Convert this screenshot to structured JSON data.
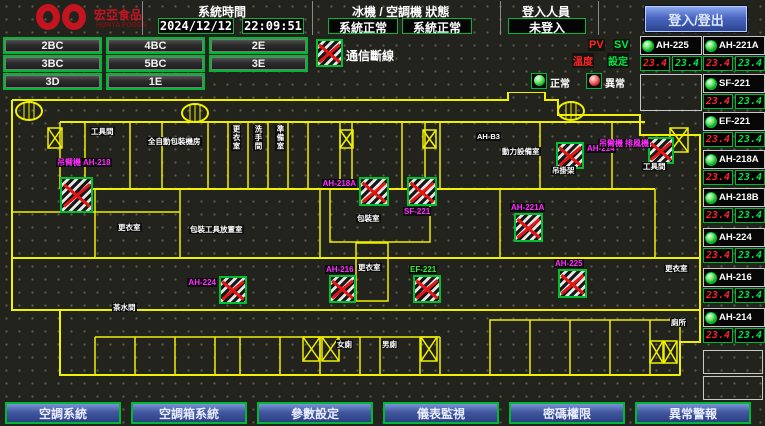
{
  "header": {
    "logo": {
      "name": "宏亞食品",
      "subname": "HUNYA FOODS"
    },
    "time_section": {
      "label": "系統時間",
      "date": "2024/12/12",
      "time": "22:09:51"
    },
    "status_section": {
      "label": "冰機 / 空調機 狀態",
      "chiller": "系統正常",
      "ahu": "系統正常"
    },
    "login_section": {
      "label": "登入人員",
      "user": "未登入",
      "button": "登入/登出"
    }
  },
  "floor_nav": {
    "rows": [
      [
        "2BC",
        "4BC",
        "2E"
      ],
      [
        "3BC",
        "5BC",
        "3E"
      ],
      [
        "3D",
        "1E"
      ]
    ]
  },
  "legend": {
    "comm_loss": "通信斷線",
    "normal": "正常",
    "abnormal": "異常",
    "pv": "PV",
    "sv": "SV",
    "pv_name": "溫度",
    "sv_name": "設定"
  },
  "equipment": [
    {
      "id": "AH-225",
      "pv": "23.4",
      "sv": "23.4",
      "status": "normal"
    },
    {
      "id": "AH-221A",
      "pv": "23.4",
      "sv": "23.4",
      "status": "normal"
    },
    {
      "id": "SF-221",
      "pv": "23.4",
      "sv": "23.4",
      "status": "normal"
    },
    {
      "id": "EF-221",
      "pv": "23.4",
      "sv": "23.4",
      "status": "normal"
    },
    {
      "id": "AH-218A",
      "pv": "23.4",
      "sv": "23.4",
      "status": "normal"
    },
    {
      "id": "AH-218B",
      "pv": "23.4",
      "sv": "23.4",
      "status": "normal"
    },
    {
      "id": "AH-224",
      "pv": "23.4",
      "sv": "23.4",
      "status": "normal"
    },
    {
      "id": "AH-216",
      "pv": "23.4",
      "sv": "23.4",
      "status": "normal"
    },
    {
      "id": "AH-214",
      "pv": "23.4",
      "sv": "23.4",
      "status": "normal"
    }
  ],
  "nav_buttons": [
    "空調系統",
    "空調箱系統",
    "參數設定",
    "儀表監視",
    "密碼權限",
    "異常警報"
  ],
  "colors": {
    "accent_green": "#00b833",
    "alarm_red": "#e31515",
    "equip_magenta": "#ff2bff",
    "wall_yellow": "#f0f000",
    "nav_blue": "#41579f",
    "logo_red": "#c41420"
  },
  "map": {
    "markers": [
      {
        "id": "AH-218",
        "x": 60,
        "y": 177,
        "w": 33,
        "h": 36,
        "label": [
          "吊臂機",
          "AH-218"
        ],
        "color": "#ff2bff",
        "pos": "above"
      },
      {
        "id": "AH-218A",
        "x": 359,
        "y": 177,
        "w": 30,
        "h": 29,
        "label": [
          "AH-218A"
        ],
        "color": "#ff2bff",
        "pos": "left"
      },
      {
        "id": "SF-221",
        "x": 407,
        "y": 177,
        "w": 30,
        "h": 29,
        "label": [
          "SF-221"
        ],
        "color": "#ff2bff",
        "pos": "below"
      },
      {
        "id": "AH-214",
        "x": 556,
        "y": 142,
        "w": 28,
        "h": 27,
        "label": [
          "AH-214"
        ],
        "color": "#ff2bff",
        "pos": "right"
      },
      {
        "id": "crane",
        "x": 648,
        "y": 137,
        "w": 26,
        "h": 27,
        "label": [
          "吊臂機",
          "排風機"
        ],
        "color": "#ff2bff",
        "pos": "left"
      },
      {
        "id": "AH-221A",
        "x": 514,
        "y": 213,
        "w": 29,
        "h": 29,
        "label": [
          "AH-221A"
        ],
        "color": "#ff2bff",
        "pos": "above"
      },
      {
        "id": "AH-224",
        "x": 219,
        "y": 276,
        "w": 28,
        "h": 28,
        "label": [
          "AH-224"
        ],
        "color": "#ff2bff",
        "pos": "left"
      },
      {
        "id": "AH-216",
        "x": 329,
        "y": 275,
        "w": 27,
        "h": 28,
        "label": [
          "AH-216"
        ],
        "color": "#ff2bff",
        "pos": "above"
      },
      {
        "id": "EF-221",
        "x": 413,
        "y": 275,
        "w": 28,
        "h": 28,
        "label": [
          "EF-221"
        ],
        "color": "#33ee33",
        "pos": "above"
      },
      {
        "id": "AH-225",
        "x": 558,
        "y": 269,
        "w": 29,
        "h": 29,
        "label": [
          "AH-225"
        ],
        "color": "#ff2bff",
        "pos": "above"
      }
    ],
    "room_labels": [
      {
        "text": "工具間",
        "x": 90,
        "y": 127,
        "vert": false
      },
      {
        "text": "全自動包裝機房",
        "x": 147,
        "y": 137,
        "vert": false
      },
      {
        "text": "更衣室",
        "x": 231,
        "y": 125,
        "vert": true
      },
      {
        "text": "洗手間",
        "x": 253,
        "y": 125,
        "vert": true
      },
      {
        "text": "準備室",
        "x": 275,
        "y": 125,
        "vert": true
      },
      {
        "text": "AH-B3",
        "x": 476,
        "y": 132,
        "vert": false
      },
      {
        "text": "動力設備室",
        "x": 501,
        "y": 147,
        "vert": false
      },
      {
        "text": "吊掛架",
        "x": 551,
        "y": 166,
        "vert": false
      },
      {
        "text": "工具間",
        "x": 642,
        "y": 162,
        "vert": false
      },
      {
        "text": "包裝室",
        "x": 356,
        "y": 214,
        "vert": false
      },
      {
        "text": "更衣室",
        "x": 117,
        "y": 223,
        "vert": false
      },
      {
        "text": "包裝工具放置室",
        "x": 189,
        "y": 225,
        "vert": false
      },
      {
        "text": "茶水間",
        "x": 112,
        "y": 303,
        "vert": false
      },
      {
        "text": "更衣室",
        "x": 357,
        "y": 263,
        "vert": false
      },
      {
        "text": "更衣室",
        "x": 664,
        "y": 264,
        "vert": false
      },
      {
        "text": "廁所",
        "x": 670,
        "y": 318,
        "vert": false
      },
      {
        "text": "女廁",
        "x": 336,
        "y": 340,
        "vert": false
      },
      {
        "text": "男廁",
        "x": 381,
        "y": 340,
        "vert": false
      }
    ]
  }
}
